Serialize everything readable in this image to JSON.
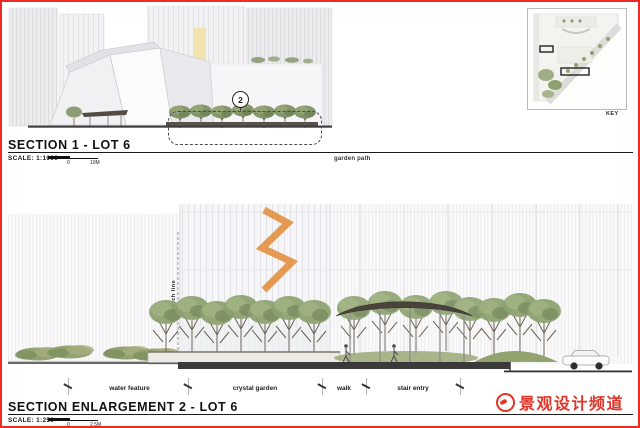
{
  "colors": {
    "page_border": "#ee2b24",
    "watermark_red": "#e23428",
    "ink": "#1a1a1a",
    "foliage_green": "#8ba06e",
    "canopy_shell_dark": "#4a433c",
    "sculpture_orange": "#e08a35",
    "facade_light": "#f4f4f6"
  },
  "section1": {
    "title": "SECTION 1 - LOT 6",
    "scale_label": "SCALE: 1:1000",
    "scale_zero": "0",
    "scale_max": "10M",
    "marker": "2",
    "annotation": "garden path"
  },
  "keymap": {
    "label": "KEY"
  },
  "section2": {
    "title": "SECTION ENLARGEMENT 2 - LOT 6",
    "scale_label": "SCALE: 1:250",
    "scale_zero": "0",
    "scale_max": "2.5M",
    "match_line": "match line",
    "zones": [
      "water feature",
      "crystal garden",
      "walk",
      "stair entry"
    ]
  },
  "watermark": {
    "text": "景观设计频道"
  }
}
